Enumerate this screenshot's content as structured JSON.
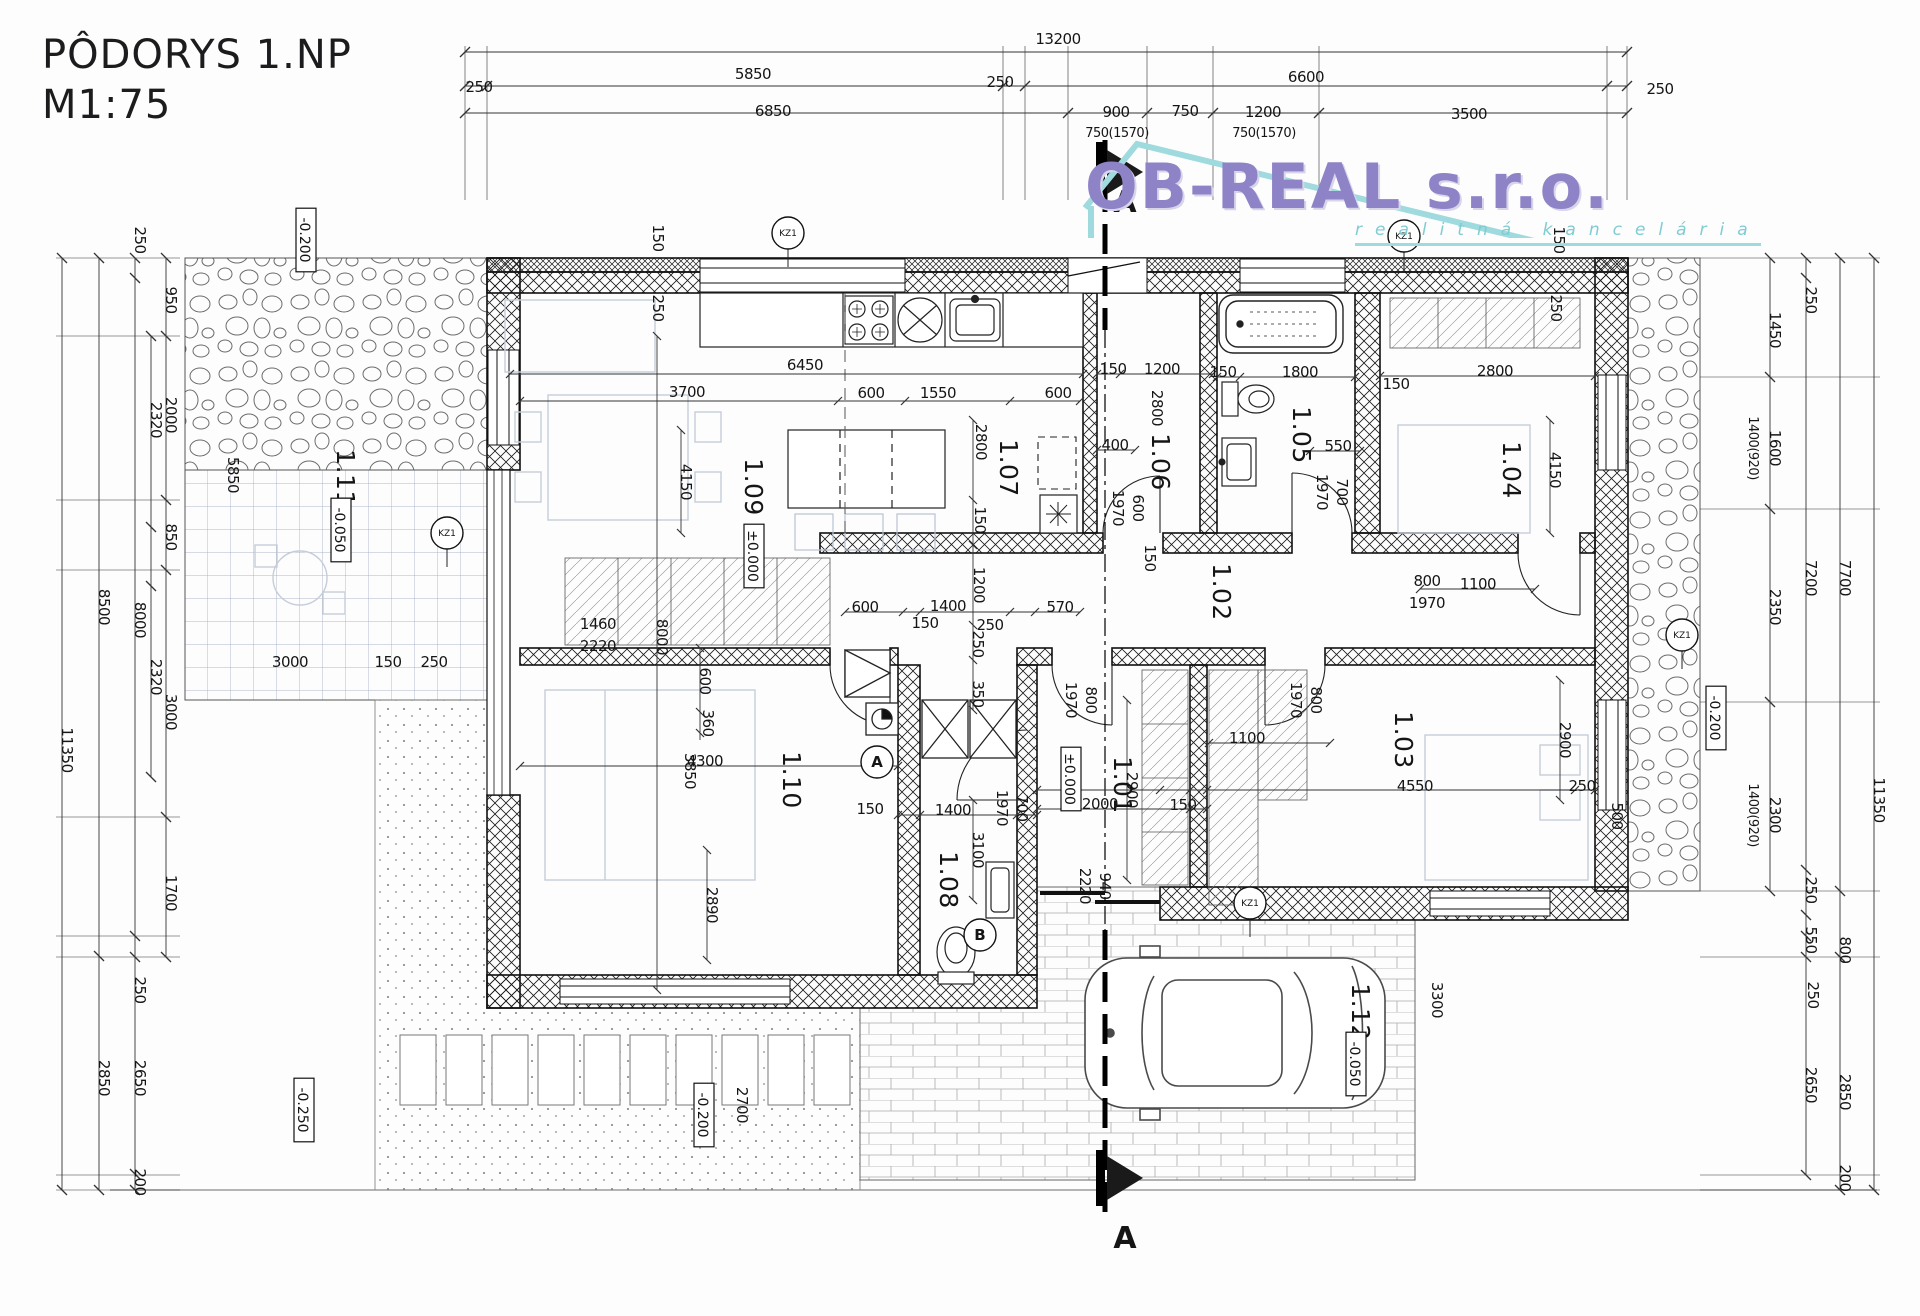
{
  "title": {
    "line1": "PÔDORYS 1.NP",
    "line2": "M1:75"
  },
  "logo": {
    "name": "OB-REAL s.r.o.",
    "subtitle": "realitná kancelária",
    "accent": "#8d83c6",
    "teal": "#9edade"
  },
  "section": {
    "letter": "A"
  },
  "rooms": [
    "1.01",
    "1.02",
    "1.03",
    "1.04",
    "1.05",
    "1.06",
    "1.07",
    "1.08",
    "1.09",
    "1.10",
    "1.11",
    "1.12"
  ],
  "elevations": [
    "±0.000",
    "-0.050",
    "-0.200",
    "-0.250"
  ],
  "markers": {
    "kz": [
      {
        "t": "KZ1",
        "x": 788,
        "y": 233
      },
      {
        "t": "KZ1",
        "x": 1404,
        "y": 236
      },
      {
        "t": "KZ1",
        "x": 447,
        "y": 533
      },
      {
        "t": "KZ1",
        "x": 1682,
        "y": 635
      },
      {
        "t": "KZ1",
        "x": 1250,
        "y": 903
      }
    ],
    "detail": [
      {
        "t": "A",
        "x": 877,
        "y": 762
      },
      {
        "t": "B",
        "x": 980,
        "y": 935
      }
    ]
  },
  "labels": [
    {
      "t": "13200",
      "x": 1058,
      "y": 44
    },
    {
      "t": "250",
      "x": 479,
      "y": 92
    },
    {
      "t": "5850",
      "x": 753,
      "y": 79
    },
    {
      "t": "250",
      "x": 1000,
      "y": 87
    },
    {
      "t": "6600",
      "x": 1306,
      "y": 82
    },
    {
      "t": "250",
      "x": 1660,
      "y": 94
    },
    {
      "t": "6850",
      "x": 773,
      "y": 116
    },
    {
      "t": "900",
      "x": 1116,
      "y": 117
    },
    {
      "t": "750",
      "x": 1185,
      "y": 116
    },
    {
      "t": "1200",
      "x": 1263,
      "y": 117
    },
    {
      "t": "3500",
      "x": 1469,
      "y": 119
    },
    {
      "t": "750(1570)",
      "x": 1117,
      "y": 137,
      "k": "sm"
    },
    {
      "t": "750(1570)",
      "x": 1264,
      "y": 137,
      "k": "sm"
    },
    {
      "t": "11350",
      "x": 62,
      "y": 750,
      "r": 1
    },
    {
      "t": "8500",
      "x": 99,
      "y": 607,
      "r": 1
    },
    {
      "t": "2850",
      "x": 99,
      "y": 1078,
      "r": 1
    },
    {
      "t": "250",
      "x": 135,
      "y": 240,
      "r": 1
    },
    {
      "t": "8000",
      "x": 135,
      "y": 620,
      "r": 1
    },
    {
      "t": "250",
      "x": 135,
      "y": 990,
      "r": 1
    },
    {
      "t": "2650",
      "x": 135,
      "y": 1078,
      "r": 1
    },
    {
      "t": "200",
      "x": 135,
      "y": 1182,
      "r": 1
    },
    {
      "t": "2320",
      "x": 151,
      "y": 420,
      "r": 1
    },
    {
      "t": "2320",
      "x": 151,
      "y": 677,
      "r": 1
    },
    {
      "t": "950",
      "x": 166,
      "y": 300,
      "r": 1
    },
    {
      "t": "2000",
      "x": 166,
      "y": 415,
      "r": 1
    },
    {
      "t": "850",
      "x": 166,
      "y": 537,
      "r": 1
    },
    {
      "t": "3000",
      "x": 166,
      "y": 712,
      "r": 1
    },
    {
      "t": "1700",
      "x": 166,
      "y": 893,
      "r": 1
    },
    {
      "t": "250",
      "x": 1806,
      "y": 300,
      "r": 1
    },
    {
      "t": "1450",
      "x": 1770,
      "y": 330,
      "r": 1
    },
    {
      "t": "1600",
      "x": 1770,
      "y": 448,
      "r": 1
    },
    {
      "t": "1400(920)",
      "x": 1749,
      "y": 448,
      "r": 1,
      "k": "sm"
    },
    {
      "t": "2350",
      "x": 1770,
      "y": 607,
      "r": 1
    },
    {
      "t": "2300",
      "x": 1770,
      "y": 815,
      "r": 1
    },
    {
      "t": "1400(920)",
      "x": 1749,
      "y": 815,
      "r": 1,
      "k": "sm"
    },
    {
      "t": "7200",
      "x": 1806,
      "y": 578,
      "r": 1
    },
    {
      "t": "7700",
      "x": 1840,
      "y": 578,
      "r": 1
    },
    {
      "t": "250",
      "x": 1806,
      "y": 890,
      "r": 1
    },
    {
      "t": "550",
      "x": 1806,
      "y": 940,
      "r": 1
    },
    {
      "t": "800",
      "x": 1840,
      "y": 950,
      "r": 1
    },
    {
      "t": "250",
      "x": 1808,
      "y": 995,
      "r": 1
    },
    {
      "t": "2650",
      "x": 1806,
      "y": 1085,
      "r": 1
    },
    {
      "t": "2850",
      "x": 1840,
      "y": 1092,
      "r": 1
    },
    {
      "t": "11350",
      "x": 1874,
      "y": 800,
      "r": 1
    },
    {
      "t": "200",
      "x": 1840,
      "y": 1178,
      "r": 1
    },
    {
      "t": "-0.200",
      "x": 1712,
      "y": 718,
      "r": 1,
      "b": 1
    },
    {
      "t": "3300",
      "x": 1432,
      "y": 1000,
      "r": 1
    },
    {
      "t": "-0.200",
      "x": 302,
      "y": 240,
      "r": 1,
      "b": 1
    },
    {
      "t": "5850",
      "x": 228,
      "y": 475,
      "r": 1
    },
    {
      "t": "1.11",
      "x": 337,
      "y": 478,
      "r": 1,
      "k": "room"
    },
    {
      "t": "-0.050",
      "x": 337,
      "y": 530,
      "r": 1,
      "b": 1
    },
    {
      "t": "3000",
      "x": 290,
      "y": 667
    },
    {
      "t": "150",
      "x": 388,
      "y": 667
    },
    {
      "t": "250",
      "x": 434,
      "y": 667
    },
    {
      "t": "150",
      "x": 653,
      "y": 238,
      "r": 1
    },
    {
      "t": "250",
      "x": 653,
      "y": 308,
      "r": 1
    },
    {
      "t": "150",
      "x": 1554,
      "y": 240,
      "r": 1
    },
    {
      "t": "250",
      "x": 1551,
      "y": 308,
      "r": 1
    },
    {
      "t": "6450",
      "x": 805,
      "y": 370
    },
    {
      "t": "3700",
      "x": 687,
      "y": 397
    },
    {
      "t": "600",
      "x": 871,
      "y": 398
    },
    {
      "t": "1550",
      "x": 938,
      "y": 398
    },
    {
      "t": "600",
      "x": 1058,
      "y": 398
    },
    {
      "t": "4150",
      "x": 681,
      "y": 482,
      "r": 1
    },
    {
      "t": "8000",
      "x": 657,
      "y": 637,
      "r": 1
    },
    {
      "t": "1.09",
      "x": 745,
      "y": 487,
      "r": 1,
      "k": "room"
    },
    {
      "t": "±0.000",
      "x": 750,
      "y": 556,
      "r": 1,
      "b": 1
    },
    {
      "t": "2800",
      "x": 976,
      "y": 442,
      "r": 1
    },
    {
      "t": "150",
      "x": 975,
      "y": 520,
      "r": 1
    },
    {
      "t": "1200",
      "x": 974,
      "y": 585,
      "r": 1
    },
    {
      "t": "250",
      "x": 973,
      "y": 644,
      "r": 1
    },
    {
      "t": "350",
      "x": 973,
      "y": 694,
      "r": 1
    },
    {
      "t": "1460",
      "x": 598,
      "y": 629
    },
    {
      "t": "2220",
      "x": 598,
      "y": 651
    },
    {
      "t": "1.07",
      "x": 1000,
      "y": 468,
      "r": 1,
      "k": "room"
    },
    {
      "t": "1.06",
      "x": 1152,
      "y": 462,
      "r": 1,
      "k": "room"
    },
    {
      "t": "400",
      "x": 1115,
      "y": 450
    },
    {
      "t": "150",
      "x": 1113,
      "y": 374
    },
    {
      "t": "1200",
      "x": 1162,
      "y": 374
    },
    {
      "t": "2800",
      "x": 1152,
      "y": 408,
      "r": 1
    },
    {
      "t": "150",
      "x": 1145,
      "y": 558,
      "r": 1
    },
    {
      "t": "600",
      "x": 1133,
      "y": 508,
      "r": 1
    },
    {
      "t": "1970",
      "x": 1113,
      "y": 508,
      "r": 1
    },
    {
      "t": "1.05",
      "x": 1293,
      "y": 435,
      "r": 1,
      "k": "room"
    },
    {
      "t": "150",
      "x": 1223,
      "y": 377
    },
    {
      "t": "1800",
      "x": 1300,
      "y": 377
    },
    {
      "t": "550",
      "x": 1338,
      "y": 451
    },
    {
      "t": "700",
      "x": 1337,
      "y": 492,
      "r": 1
    },
    {
      "t": "1970",
      "x": 1317,
      "y": 492,
      "r": 1
    },
    {
      "t": "1.04",
      "x": 1503,
      "y": 470,
      "r": 1,
      "k": "room"
    },
    {
      "t": "2800",
      "x": 1495,
      "y": 376
    },
    {
      "t": "150",
      "x": 1396,
      "y": 389
    },
    {
      "t": "4150",
      "x": 1550,
      "y": 470,
      "r": 1
    },
    {
      "t": "1.02",
      "x": 1213,
      "y": 592,
      "r": 1,
      "k": "room"
    },
    {
      "t": "800",
      "x": 1427,
      "y": 586
    },
    {
      "t": "1970",
      "x": 1427,
      "y": 608
    },
    {
      "t": "1100",
      "x": 1478,
      "y": 589
    },
    {
      "t": "570",
      "x": 1060,
      "y": 612
    },
    {
      "t": "600",
      "x": 865,
      "y": 612
    },
    {
      "t": "1400",
      "x": 948,
      "y": 611
    },
    {
      "t": "150",
      "x": 925,
      "y": 628
    },
    {
      "t": "250",
      "x": 990,
      "y": 630
    },
    {
      "t": "1.01",
      "x": 1114,
      "y": 785,
      "r": 1,
      "k": "room"
    },
    {
      "t": "±0.000",
      "x": 1067,
      "y": 779,
      "r": 1,
      "b": 1
    },
    {
      "t": "800",
      "x": 1086,
      "y": 700,
      "r": 1
    },
    {
      "t": "1970",
      "x": 1066,
      "y": 700,
      "r": 1
    },
    {
      "t": "2900",
      "x": 1127,
      "y": 790,
      "r": 1
    },
    {
      "t": "2000",
      "x": 1100,
      "y": 809
    },
    {
      "t": "150",
      "x": 1183,
      "y": 810
    },
    {
      "t": "940",
      "x": 1100,
      "y": 886,
      "r": 1
    },
    {
      "t": "2220",
      "x": 1080,
      "y": 886,
      "r": 1
    },
    {
      "t": "1.03",
      "x": 1395,
      "y": 740,
      "r": 1,
      "k": "room"
    },
    {
      "t": "800",
      "x": 1311,
      "y": 700,
      "r": 1
    },
    {
      "t": "1970",
      "x": 1291,
      "y": 700,
      "r": 1
    },
    {
      "t": "1100",
      "x": 1247,
      "y": 743
    },
    {
      "t": "4550",
      "x": 1415,
      "y": 791
    },
    {
      "t": "250",
      "x": 1582,
      "y": 791
    },
    {
      "t": "500",
      "x": 1612,
      "y": 816,
      "r": 1
    },
    {
      "t": "2900",
      "x": 1560,
      "y": 740,
      "r": 1
    },
    {
      "t": "1.10",
      "x": 783,
      "y": 780,
      "r": 1,
      "k": "room"
    },
    {
      "t": "600",
      "x": 700,
      "y": 681,
      "r": 1
    },
    {
      "t": "360",
      "x": 703,
      "y": 723,
      "r": 1
    },
    {
      "t": "3850",
      "x": 685,
      "y": 771,
      "r": 1
    },
    {
      "t": "4300",
      "x": 705,
      "y": 766
    },
    {
      "t": "2890",
      "x": 707,
      "y": 905,
      "r": 1
    },
    {
      "t": "1.08",
      "x": 940,
      "y": 880,
      "r": 1,
      "k": "room"
    },
    {
      "t": "3100",
      "x": 973,
      "y": 850,
      "r": 1
    },
    {
      "t": "700",
      "x": 1017,
      "y": 808,
      "r": 1
    },
    {
      "t": "1970",
      "x": 997,
      "y": 808,
      "r": 1
    },
    {
      "t": "1400",
      "x": 953,
      "y": 815
    },
    {
      "t": "150",
      "x": 870,
      "y": 814
    },
    {
      "t": "2700",
      "x": 737,
      "y": 1105,
      "r": 1
    },
    {
      "t": "-0.200",
      "x": 700,
      "y": 1115,
      "r": 1,
      "b": 1
    },
    {
      "t": "-0.250",
      "x": 300,
      "y": 1110,
      "r": 1,
      "b": 1
    },
    {
      "t": "1.12",
      "x": 1352,
      "y": 1012,
      "r": 1,
      "k": "room"
    },
    {
      "t": "-0.050",
      "x": 1352,
      "y": 1064,
      "r": 1,
      "b": 1
    }
  ]
}
